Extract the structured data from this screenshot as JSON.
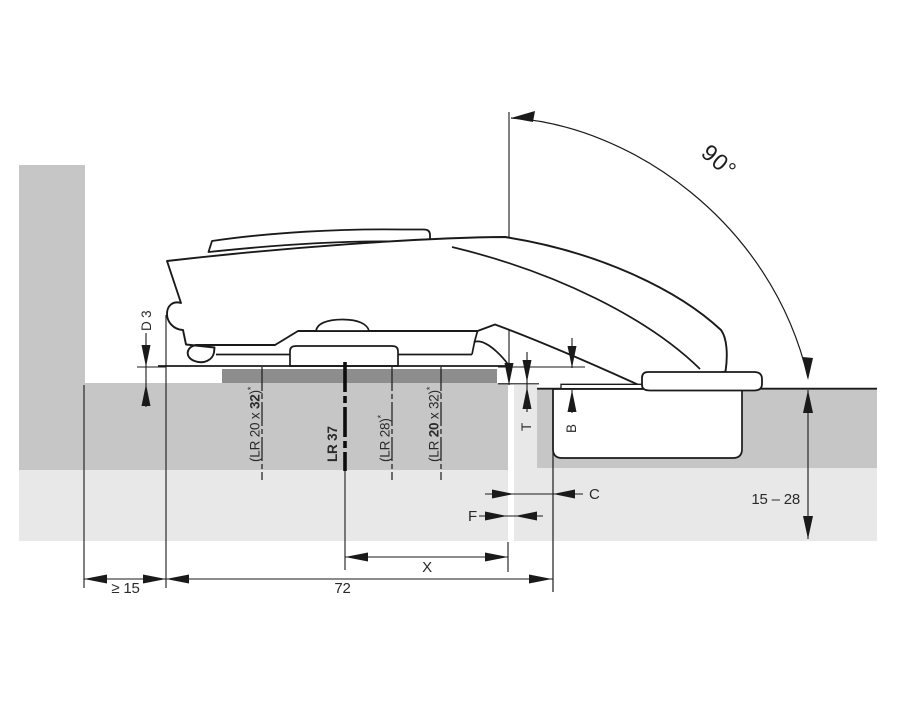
{
  "figure": {
    "title": "Flap fitting installation drawing, side section",
    "colors": {
      "panel_medium": "#c6c6c6",
      "panel_light": "#e8e8e8",
      "recess_dark": "#8d8d8d",
      "line": "#1a1a1a",
      "text": "#2a2a2a"
    },
    "labels": {
      "opening_angle": "90°",
      "recess_depth": "D 3",
      "min_side_clearance": "≥ 15",
      "fitting_length": "72",
      "dim_x": "X",
      "dim_c": "C",
      "dim_f": "F",
      "dim_t": "T",
      "dim_b": "B",
      "door_thickness_range": "15 – 28"
    },
    "drill_rows": [
      {
        "id": "lr-20x32-left",
        "runs": [
          {
            "text": "(LR 20 x "
          },
          {
            "text": "32",
            "bold": true
          },
          {
            "text": ")"
          },
          {
            "text": "*",
            "sup": true
          }
        ]
      },
      {
        "id": "lr-37",
        "runs": [
          {
            "text": "LR 37",
            "bold": true
          }
        ]
      },
      {
        "id": "lr-28",
        "runs": [
          {
            "text": "(LR 28)"
          },
          {
            "text": "*",
            "sup": true
          }
        ]
      },
      {
        "id": "lr-20x32-right",
        "runs": [
          {
            "text": "(LR "
          },
          {
            "text": "20",
            "bold": true
          },
          {
            "text": " x 32)"
          },
          {
            "text": "*",
            "sup": true
          }
        ]
      }
    ]
  }
}
